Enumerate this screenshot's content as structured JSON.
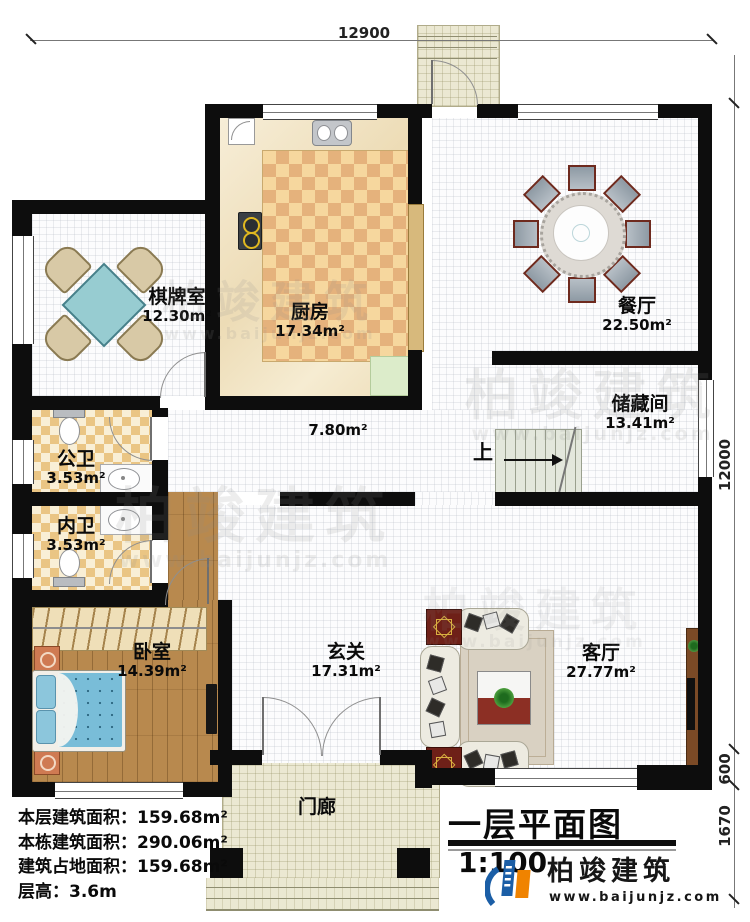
{
  "plan": {
    "title": "一层平面图",
    "scale": "1:100",
    "stairs_up": "上",
    "corridor_area": "7.80m²"
  },
  "dimensions": {
    "top": "12900",
    "right": "12000",
    "right_lower": "600",
    "right_bottom": "1670"
  },
  "rooms": [
    {
      "name": "棋牌室",
      "area": "12.30m²"
    },
    {
      "name": "厨房",
      "area": "17.34m²"
    },
    {
      "name": "餐厅",
      "area": "22.50m²"
    },
    {
      "name": "储藏间",
      "area": "13.41m²"
    },
    {
      "name": "公卫",
      "area": "3.53m²"
    },
    {
      "name": "内卫",
      "area": "3.53m²"
    },
    {
      "name": "卧室",
      "area": "14.39m²"
    },
    {
      "name": "玄关",
      "area": "17.31m²"
    },
    {
      "name": "客厅",
      "area": "27.77m²"
    },
    {
      "name": "门廊",
      "area": ""
    }
  ],
  "info": {
    "lines": [
      "本层建筑面积：159.68m²",
      "本栋建筑面积：290.06m²",
      "建筑占地面积：159.68m²",
      "层高：3.6m"
    ]
  },
  "logo": {
    "name": "柏竣建筑",
    "url": "www.baijunjz.com"
  },
  "watermark": {
    "text": "柏竣建筑",
    "url": "www.baijunjz.com"
  },
  "colors": {
    "accent_blue": "#1b5ea6",
    "accent_orange": "#f08300",
    "wall": "#0d0d0d"
  }
}
